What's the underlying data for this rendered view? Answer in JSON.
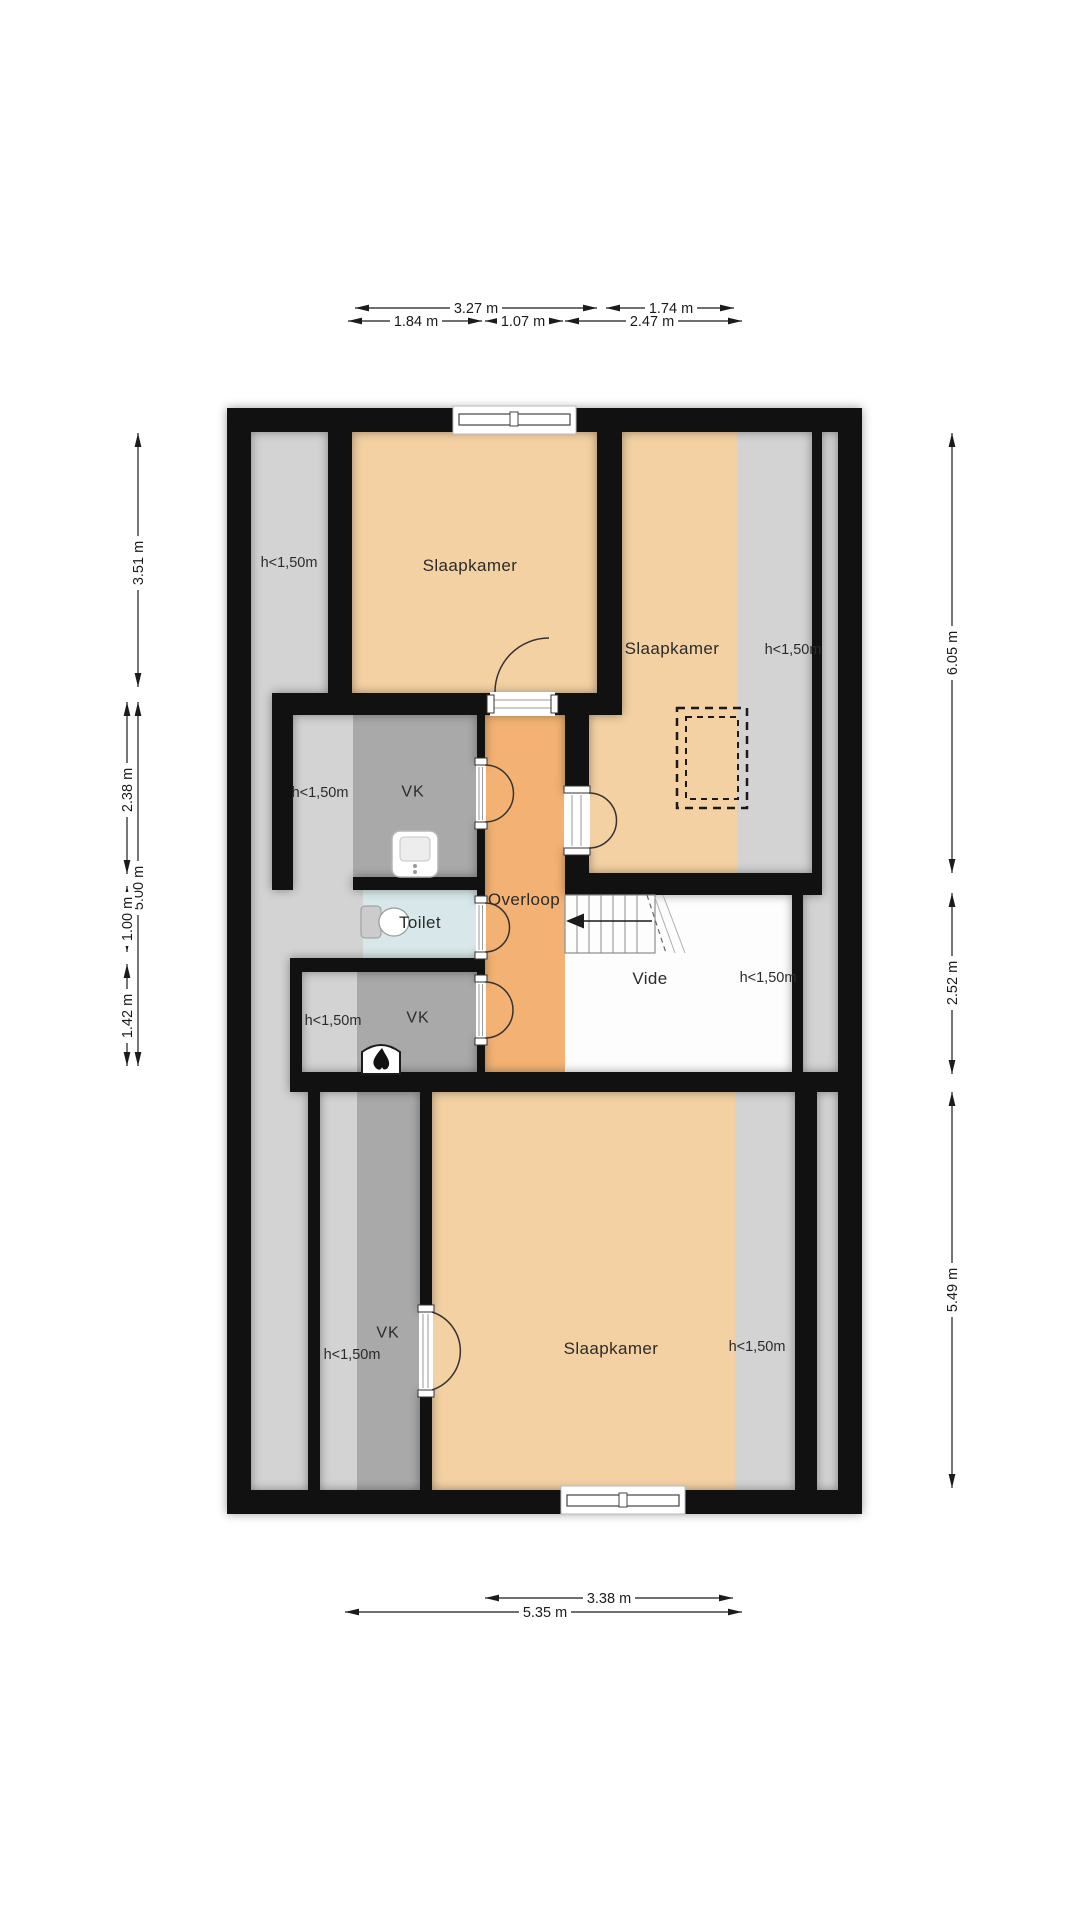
{
  "plan_type": "floor-plan",
  "rooms": {
    "slaapkamer_top": {
      "label": "Slaapkamer"
    },
    "slaapkamer_right": {
      "label": "Slaapkamer"
    },
    "slaapkamer_bottom": {
      "label": "Slaapkamer"
    },
    "overloop": {
      "label": "Overloop"
    },
    "toilet": {
      "label": "Toilet"
    },
    "vide": {
      "label": "Vide"
    },
    "vk_upper": {
      "label": "VK"
    },
    "vk_lower": {
      "label": "VK"
    },
    "vk_bottom": {
      "label": "VK"
    }
  },
  "low_height_label": "h<1,50m",
  "dimensions": {
    "top_row1": [
      "3.27 m",
      "1.74 m"
    ],
    "top_row2": [
      "1.84 m",
      "1.07 m",
      "2.47 m"
    ],
    "bottom": [
      "3.38 m",
      "5.35 m"
    ],
    "left": [
      "3.51 m",
      "5.00 m",
      "2.38 m",
      "1.00 m",
      "1.42 m"
    ],
    "right": [
      "6.05 m",
      "2.52 m",
      "5.49 m"
    ]
  },
  "icons": [
    "stairs-icon",
    "stairs-direction-arrow-icon",
    "toilet-icon",
    "sink-icon",
    "fireplace-icon",
    "chimney-dashed-icon",
    "window-icon",
    "door-swing-icon"
  ],
  "colors": {
    "wall": "#111111",
    "floor_room": "#f3d1a3",
    "floor_hall": "#f3b273",
    "floor_low": "#d3d3d3",
    "floor_closet": "#a9a9a9",
    "floor_toilet": "#d8e8ea",
    "floor_void": "#fdfdfd"
  }
}
